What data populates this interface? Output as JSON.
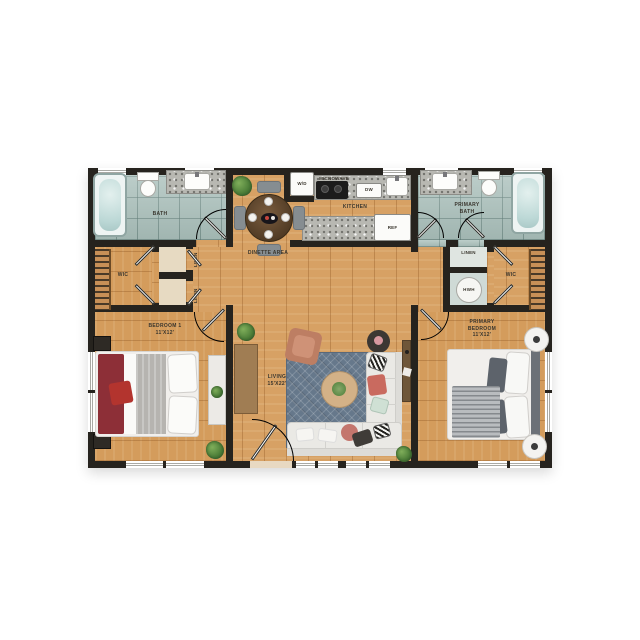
{
  "colors": {
    "wall": "#26231e",
    "wood": "#d7a164",
    "tile": "#a9bfba",
    "granite": "#b8b8b2",
    "rug": "#66788b",
    "sofa": "#eae9e5",
    "accent_chair": "#bd7e63",
    "bed_throw_red": "#8d2f37",
    "pillow_red": "#b3342e",
    "blanket_gray": "#b6b4b0",
    "coffee_table": "#d3b187",
    "dinette_table": "#5d452e",
    "console_wood": "#a07d53",
    "desk_wood": "#6e5639",
    "plant_green": "#4c7d38",
    "door_arc": "#8a5f36",
    "label_text": "#3a362e"
  },
  "labels": {
    "bath": "BATH",
    "primary_bath": [
      "PRIMARY",
      "BATH"
    ],
    "kitchen": "KITCHEN",
    "microwave": "MICROWAVE",
    "dishwasher": "DW",
    "refrigerator": "REF",
    "washer_dryer": "W/D",
    "dinette": "DINETTE AREA",
    "wic": "WIC",
    "linen": "LINEN",
    "hwh": "HWH",
    "bedroom1": [
      "BEDROOM 1",
      "11'X12'"
    ],
    "living": [
      "LIVING",
      "15'X22'"
    ],
    "primary_bedroom": [
      "PRIMARY",
      "BEDROOM",
      "11'X12'"
    ]
  }
}
